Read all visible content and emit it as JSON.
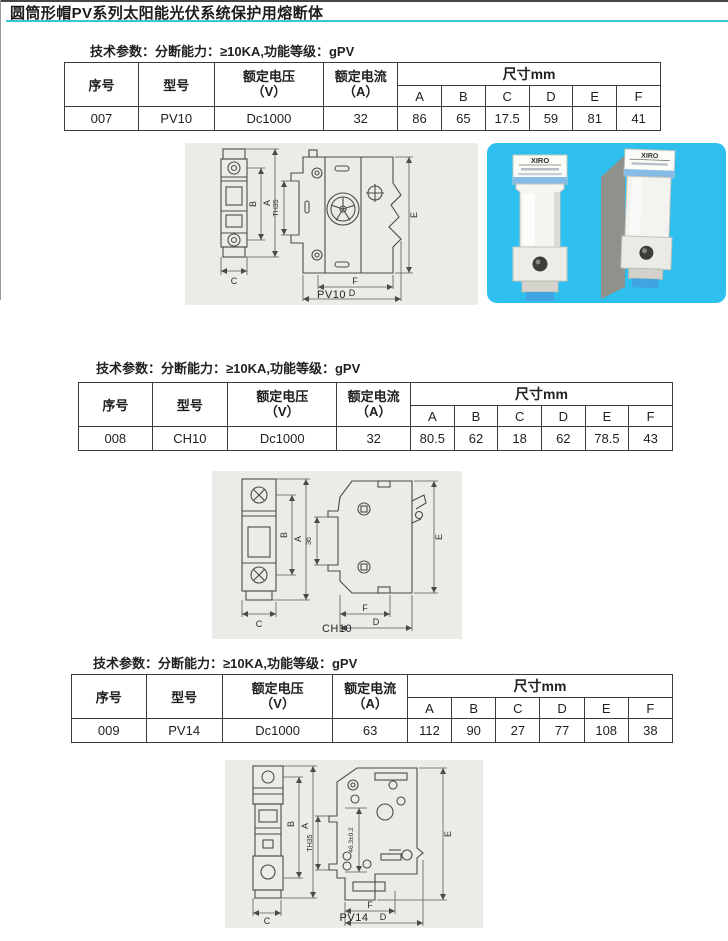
{
  "page": {
    "title": "圆筒形帽PV系列太阳能光伏系统保护用熔断体",
    "accent_color": "#35c6d8",
    "photo_background_color": "#2fbfee"
  },
  "table_headers": {
    "serial": "序号",
    "model": "型号",
    "voltage_line1": "额定电压",
    "voltage_line2": "（V）",
    "current_line1": "额定电流",
    "current_line2": "（A）",
    "dims_group": "尺寸mm",
    "dims": [
      "A",
      "B",
      "C",
      "D",
      "E",
      "F"
    ]
  },
  "sections": [
    {
      "tech_params": "技术参数：分断能力：≥10KA,功能等级：gPV",
      "row": {
        "serial": "007",
        "model": "PV10",
        "voltage": "Dc1000",
        "current": "32",
        "dims": [
          "86",
          "65",
          "17.5",
          "59",
          "81",
          "41"
        ]
      },
      "figure": {
        "caption": "PV10",
        "rail_label": "TH35"
      }
    },
    {
      "tech_params": "技术参数：分断能力：≥10KA,功能等级：gPV",
      "row": {
        "serial": "008",
        "model": "CH10",
        "voltage": "Dc1000",
        "current": "32",
        "dims": [
          "80.5",
          "62",
          "18",
          "62",
          "78.5",
          "43"
        ]
      },
      "figure": {
        "caption": "CH10",
        "rail_label": "36"
      }
    },
    {
      "tech_params": "技术参数：分断能力：≥10KA,功能等级：gPV",
      "row": {
        "serial": "009",
        "model": "PV14",
        "voltage": "Dc1000",
        "current": "63",
        "dims": [
          "112",
          "90",
          "27",
          "77",
          "108",
          "38"
        ]
      },
      "figure": {
        "caption": "PV14",
        "rail_label": "TH35",
        "extra_dim": "46.3±0.2"
      }
    }
  ],
  "photo": {
    "brand": "XIRO"
  }
}
